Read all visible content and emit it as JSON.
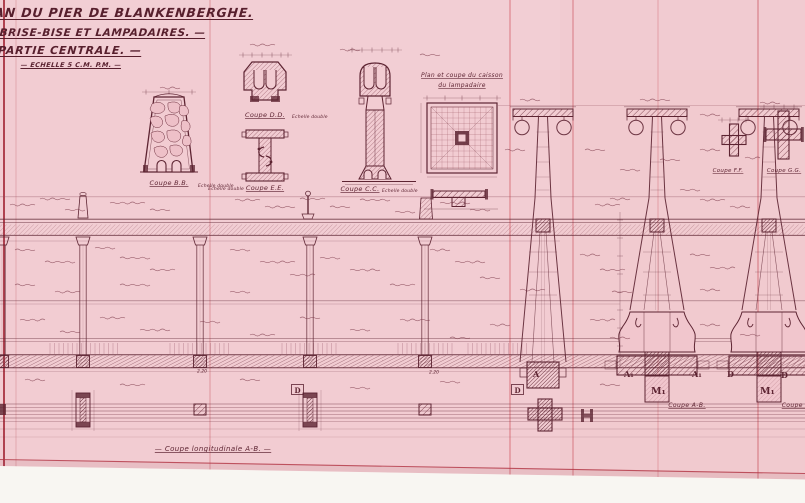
{
  "title_block": {
    "line1": "AN DU PIER DE BLANKENBERGHE.",
    "line2": "BRISE-BISE ET LAMPADAIRES. —",
    "line3": "PARTIE CENTRALE. —",
    "line4": "— ECHELLE 5 C.M. P.M. —"
  },
  "detail_labels": {
    "coupe_bb": "Coupe B.B.",
    "coupe_bb_note": "Echelle double",
    "coupe_dd": "Coupe D.D.",
    "coupe_dd_note": "Echelle double",
    "coupe_ee": "Coupe E.E.",
    "coupe_ee_note": "Echelle double",
    "coupe_cc": "Coupe C.C.",
    "coupe_cc_note": "Echelle double",
    "plan_caisson_line1": "Plan et coupe du caisson",
    "plan_caisson_line2": "du lampadaire",
    "coupe_ff": "Coupe F.F.",
    "coupe_gg": "Coupe G.G."
  },
  "section_labels": {
    "coupe_longitudinale": "— Coupe longitudinale A-B. —",
    "coupe_ab_left": "Coupe A-B.",
    "coupe_ab_right": "Coupe A-"
  },
  "markers": {
    "a": "A",
    "a1_left": "A₁",
    "a1_mid": "A₁",
    "d_mid": "D",
    "d_right": "D",
    "m1_left": "M₁",
    "m1_right": "M₁",
    "d_box_left": "D",
    "d_box_right": "D"
  },
  "dimensions": {
    "dim_left": "2.20",
    "dim_right": "2.20"
  },
  "colors": {
    "paper": "#f2ccd2",
    "ink": "#5d2432",
    "ink_light": "#8d4b5a",
    "crease": "#d4606a",
    "border_red": "#b23443",
    "page_white": "#f8f6f2"
  }
}
